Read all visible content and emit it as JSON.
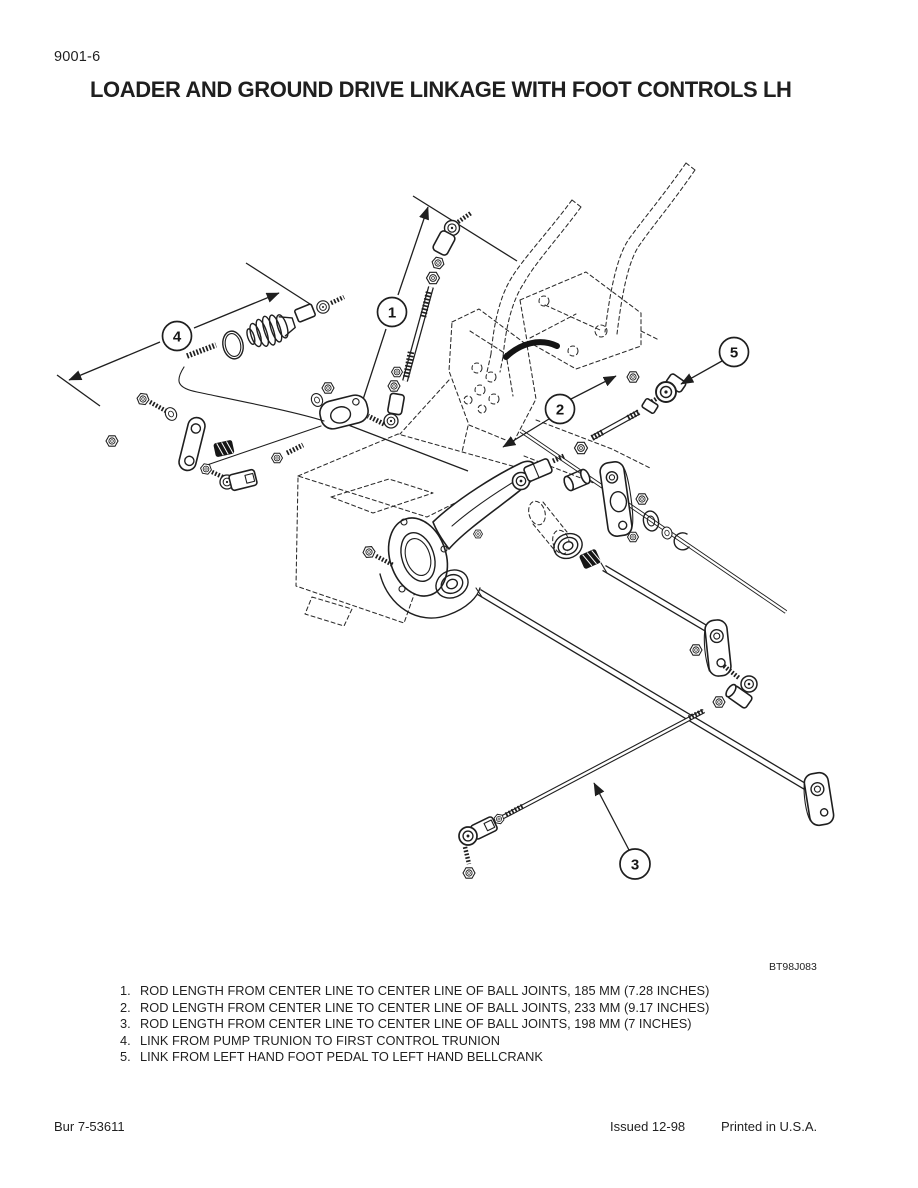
{
  "page": {
    "number": "9001-6",
    "title": "LOADER AND GROUND DRIVE LINKAGE WITH FOOT CONTROLS LH"
  },
  "figure": {
    "code": "BT98J083",
    "description": "Exploded line drawing of loader and ground drive linkage with foot controls, left hand",
    "callouts": [
      {
        "number": "1"
      },
      {
        "number": "2"
      },
      {
        "number": "3"
      },
      {
        "number": "4"
      },
      {
        "number": "5"
      }
    ]
  },
  "legend": {
    "items": [
      {
        "number": "1.",
        "text": "ROD LENGTH FROM CENTER LINE TO CENTER LINE OF BALL JOINTS, 185 MM (7.28 INCHES)"
      },
      {
        "number": "2.",
        "text": "ROD LENGTH FROM CENTER LINE TO CENTER LINE OF BALL JOINTS, 233 MM (9.17 INCHES)"
      },
      {
        "number": "3.",
        "text": "ROD LENGTH FROM CENTER LINE TO CENTER LINE OF BALL JOINTS, 198 MM (7 INCHES)"
      },
      {
        "number": "4.",
        "text": "LINK FROM PUMP TRUNION TO FIRST CONTROL TRUNION"
      },
      {
        "number": "5.",
        "text": "LINK FROM LEFT HAND FOOT PEDAL TO LEFT HAND BELLCRANK"
      }
    ]
  },
  "footer": {
    "left": "Bur 7-53611",
    "issued": "Issued 12-98",
    "printed": "Printed in U.S.A."
  },
  "colors": {
    "ink": "#1f1f1f",
    "paper": "#ffffff"
  }
}
